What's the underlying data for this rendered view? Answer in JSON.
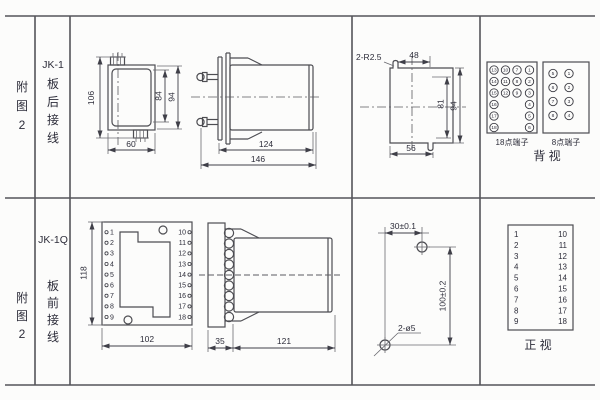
{
  "sheet": {
    "row1": {
      "fig_label": [
        "附",
        "图",
        "2"
      ],
      "model": "JK-1",
      "wiring": [
        "板",
        "后",
        "接",
        "线"
      ],
      "front_view": {
        "dim_left": "106",
        "dim_inner": "84",
        "dim_outer": "94",
        "dim_bottom": "60"
      },
      "side_view": {
        "dim_body": "124",
        "dim_total": "146"
      },
      "cutout": {
        "radius_label": "2-R2.5",
        "dim_top": "48",
        "dim_inner": "81",
        "dim_outer": "94",
        "dim_bottom": "56"
      },
      "terminals18": {
        "label": "18点端子",
        "columns": [
          [
            13,
            14,
            15,
            16,
            17,
            18
          ],
          [
            10,
            11,
            12
          ],
          [
            7,
            8,
            9
          ],
          [
            1,
            2,
            3,
            4,
            5,
            6
          ]
        ]
      },
      "terminals8": {
        "label": "8点端子",
        "columns": [
          [
            5,
            6,
            7,
            8
          ],
          [
            1,
            2,
            3,
            4
          ]
        ]
      },
      "view_label": "背  视"
    },
    "row2": {
      "fig_label": [
        "附",
        "图",
        "2"
      ],
      "model": "JK-1Q",
      "wiring": [
        "板",
        "前",
        "接",
        "线"
      ],
      "front_view": {
        "dim_height": "118",
        "dim_width": "102",
        "left_terminals": [
          1,
          2,
          3,
          4,
          5,
          6,
          7,
          8,
          9
        ],
        "right_terminals": [
          10,
          11,
          12,
          13,
          14,
          15,
          16,
          17,
          18
        ]
      },
      "side_view": {
        "dim_plate": "35",
        "dim_body": "121"
      },
      "drill": {
        "dim_h": "30±0.1",
        "dim_v": "100±0.2",
        "hole_label": "2-ø5"
      },
      "terminal_table": {
        "left": [
          1,
          2,
          3,
          4,
          5,
          6,
          7,
          8,
          9
        ],
        "right": [
          10,
          11,
          12,
          13,
          14,
          15,
          16,
          17,
          18
        ],
        "label": "正  视"
      }
    }
  }
}
